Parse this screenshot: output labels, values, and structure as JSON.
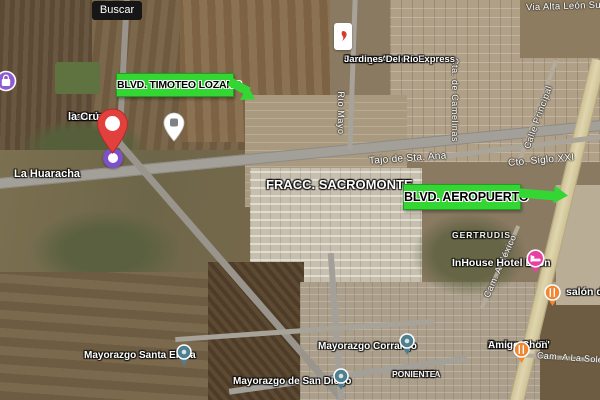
{
  "app": {
    "type": "satellite-map-view"
  },
  "search": {
    "tooltip_label": "Buscar"
  },
  "callouts": {
    "timoteo": {
      "label": "BLVD. TIMOTEO LOZANO"
    },
    "aeropuerto": {
      "label": "BLVD. AEROPUERTO"
    }
  },
  "places": {
    "rancho_la_cruz": {
      "line1": "Rancho",
      "line2": "la Cruz"
    },
    "la_huaracha": {
      "text": "La Huaracha"
    },
    "fracc_sacromonte": {
      "text": "FRACC. SACROMONTE"
    },
    "bodega_aurrera": {
      "line1": "Bodega Aurrera Express",
      "line2": "Jardines Del Río"
    },
    "santa_gertrudis": {
      "line1": "SANTA",
      "line2": "GERTRUDIS"
    },
    "inhouse_hotel": {
      "text": "InHouse Hotel León"
    },
    "salon": {
      "text": "salón de"
    },
    "mayorazgo_santa_elena": {
      "text": "Mayorazgo Santa Elena"
    },
    "mayorazgo_corralejo": {
      "text": "Mayorazgo Corralejo"
    },
    "mayorazgo_san_diego": {
      "text": "Mayorazgo de San Diego"
    },
    "barbacoa": {
      "line1": "Barbacoa 'El",
      "line2": "Amigo Chon'"
    },
    "autopista_poniente": {
      "line1": "AUTOPISTA",
      "line2": "PONIENTE"
    }
  },
  "streets": {
    "via_alta_leon_sur": "Via Alta León Sur",
    "tajo_sta_ana": "Tajo de Sta. Ana",
    "cto_siglo_xxi": "Cto. Siglo XXI",
    "rio_mayo": "Río Mayo",
    "cta_camelinas": "Cta. de Camelinas",
    "calle_principal": "Calle Principal",
    "cam_a_mexico": "Cam. A México",
    "cam_a_la_soledad": "Cam. A La Soledad"
  },
  "icons": {
    "location_pin": "red-map-pin",
    "pin_target": "purple-target-circle",
    "generic_poi": "white-map-pin",
    "store_marker": "bodega-aurrera-store-marker",
    "shopping_poi": "purple-shopping-poi",
    "hotel_poi": "pink-hotel-bed-poi",
    "restaurant_poi": "orange-fork-knife-poi",
    "area_marker": "teal-neighborhood-pin"
  },
  "colors": {
    "callout_green": "#34d634",
    "pin_red": "#e2403c",
    "target_purple": "#7d52c9",
    "shopping_purple": "#8e5bd0",
    "hotel_pink": "#e83fa4",
    "restaurant_orange": "#ef8733",
    "area_marker_teal": "#4e7f8e",
    "tooltip_black": "#161616"
  }
}
